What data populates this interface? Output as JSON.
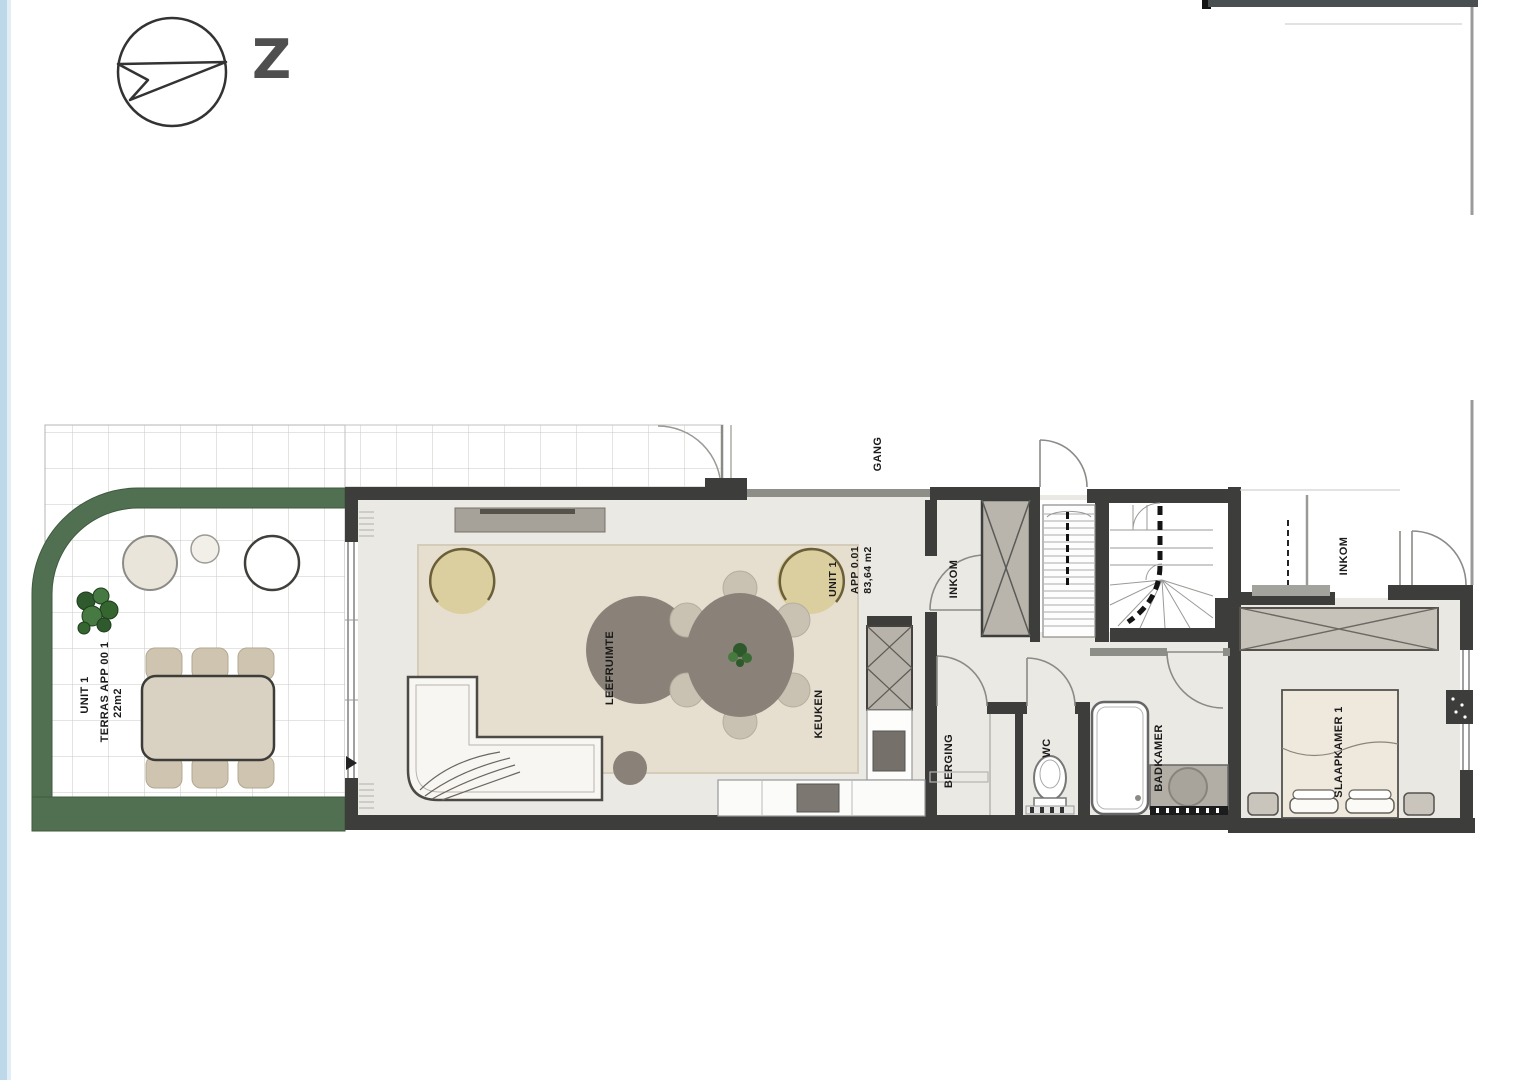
{
  "compass": {
    "direction_label": "Z"
  },
  "terrace": {
    "label_line1": "UNIT 1",
    "label_line2": "TERRAS APP 00 1",
    "label_line3": "22m2"
  },
  "apartment": {
    "unit_label": "UNIT 1",
    "app_label": "APP 0.01",
    "area_label": "83,64 m2",
    "rooms": {
      "leefruimte": "LEEFRUIMTE",
      "keuken": "KEUKEN",
      "inkom": "INKOM",
      "berging": "BERGING",
      "wc": "WC",
      "badkamer": "BADKAMER",
      "slaapkamer": "SLAAPKAMER 1"
    }
  },
  "common_areas": {
    "gang": "GANG",
    "inkom_right": "INKOM"
  },
  "colors": {
    "wall_dark": "#3d3d3b",
    "wall_light": "#8e8e89",
    "floor": "#ebe9e4",
    "hedge_green": "#517052",
    "rug": "#e6dfcf",
    "furniture_taupe": "#8a8178",
    "armchair_tan": "#dbcfa0",
    "edge_strip_blue": "#bdd8e9"
  }
}
